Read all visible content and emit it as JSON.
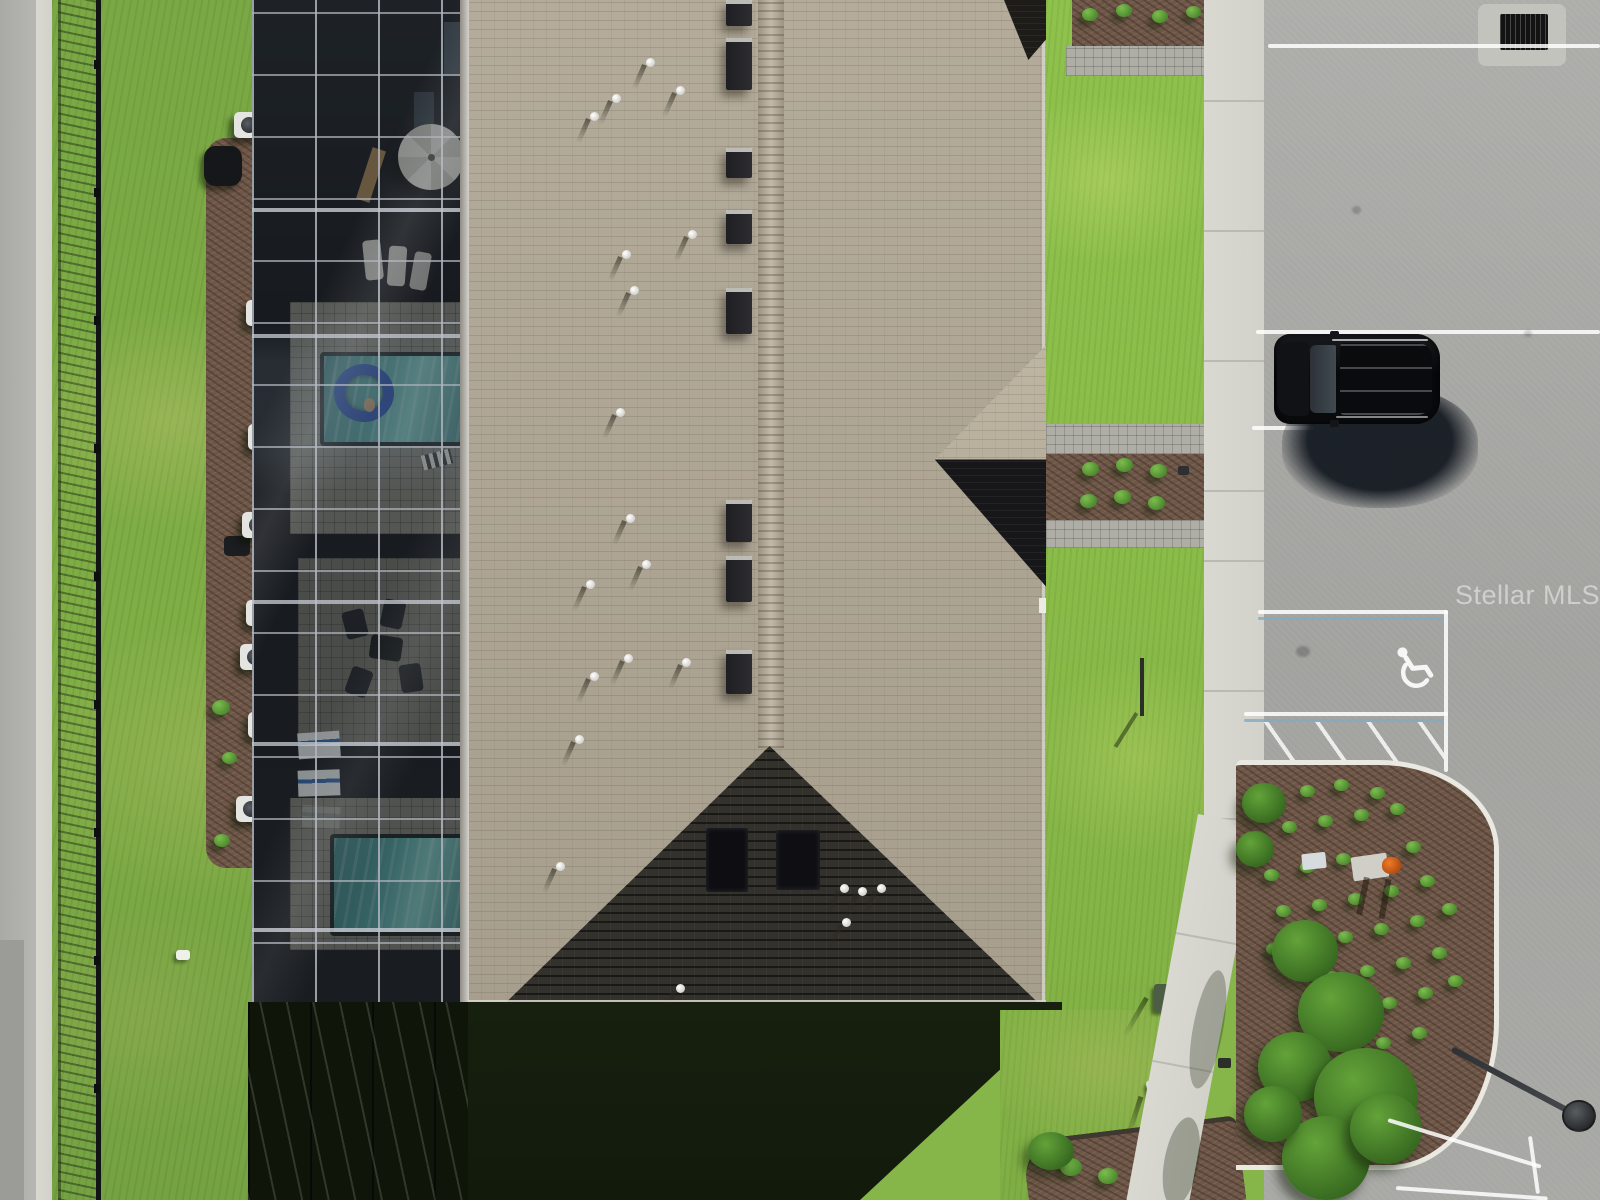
{
  "watermark": {
    "text": "Stellar MLS"
  },
  "scene": {
    "type": "aerial-drone-photo",
    "subject": "Straight-down aerial view of a townhome building with a screened pool enclosure, shingled roof, lawns, sidewalk, landscaped beds and a parking lot",
    "building": {
      "roof_color": "#b0a795",
      "shaded_roof_color": "#33312b",
      "ridge_vent_count": 8,
      "white_pipe_vents": 18,
      "entry_gables": 2
    },
    "pool_enclosure": {
      "screen_color": "#1d2126",
      "frame_color": "#9aa0a8",
      "pools": 2,
      "pool_water_color": "#58a3a3",
      "pool_float_color": "#2f55b0",
      "umbrella_color": "#efefea",
      "ac_units": 8
    },
    "parking_lot": {
      "surface_color": "#a8a8a5",
      "stall_line_color": "#ffffff",
      "accent_line_color": "#82aac3",
      "accessible_space": true,
      "hatched_access_aisle": true,
      "storm_drain": true,
      "manhole_cover": true,
      "light_pole": true
    },
    "vehicle": {
      "type": "SUV",
      "color": "black"
    },
    "landscape": {
      "grass_color": "#86b54a",
      "mulch_color": "#6e5748",
      "shrub_color": "#5ea23e",
      "fence": "black metal picket fence along left property line",
      "sidewalk_color": "#d7d6cf"
    }
  }
}
